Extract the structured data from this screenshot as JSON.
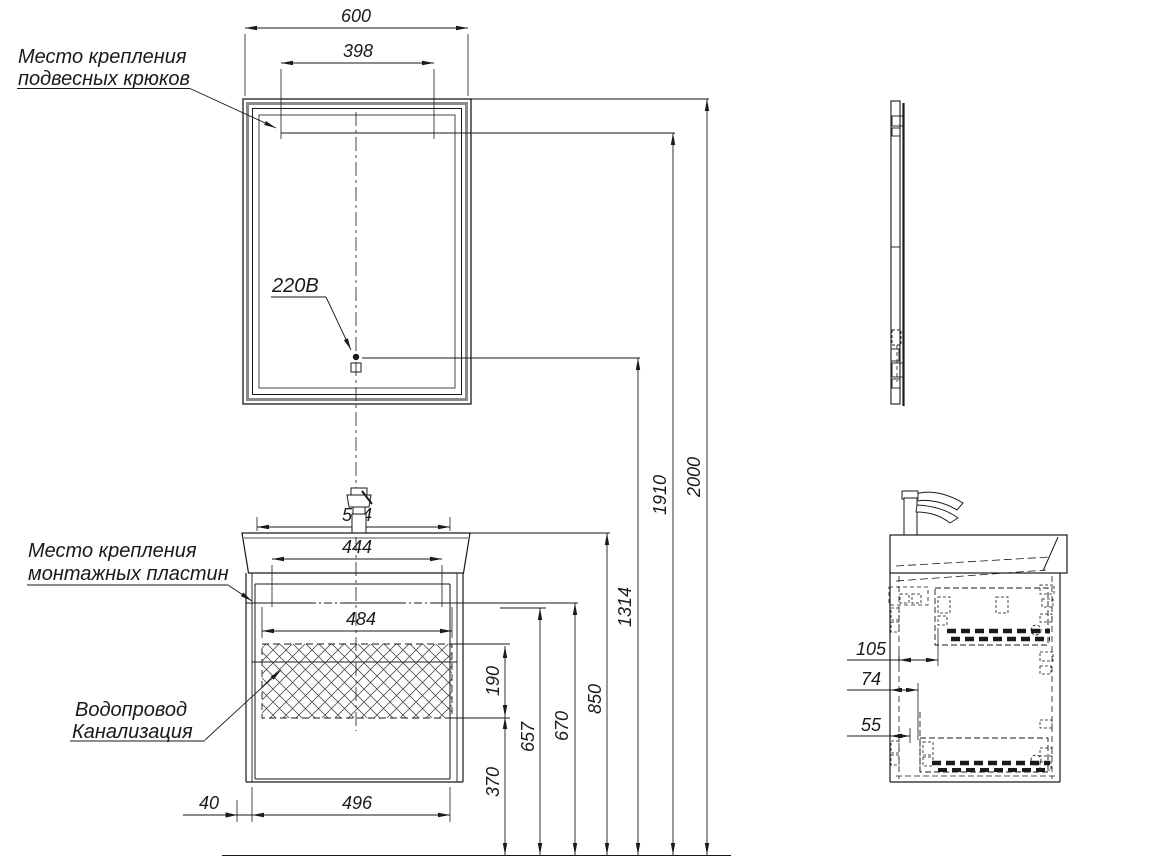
{
  "drawing": {
    "background": "#ffffff",
    "line_color": "#1a1a1a",
    "frame_color": "#8a8a8a",
    "labels": {
      "hooks_line1": "Место крепления",
      "hooks_line2": "подвесных крюков",
      "plates_line1": "Место крепления",
      "plates_line2": "монтажных пластин",
      "utilities_line1": "Водопровод",
      "utilities_line2": "Канализация",
      "power": "220В"
    },
    "dimensions_front": {
      "mirror_width": "600",
      "hooks_spacing": "398",
      "sink_width": "544",
      "plates_spacing": "444",
      "cabinet_inner_width": "484",
      "drawer_width": "496",
      "left_offset": "40"
    },
    "dimensions_height": {
      "utility_zone": "190",
      "utility_bottom": "370",
      "plates_height_1": "657",
      "plates_height_2": "670",
      "sink_top": "850",
      "socket": "1314",
      "hooks": "1910",
      "overall": "2000"
    },
    "dimensions_side": {
      "depth_1": "105",
      "depth_2": "74",
      "depth_3": "55"
    }
  }
}
